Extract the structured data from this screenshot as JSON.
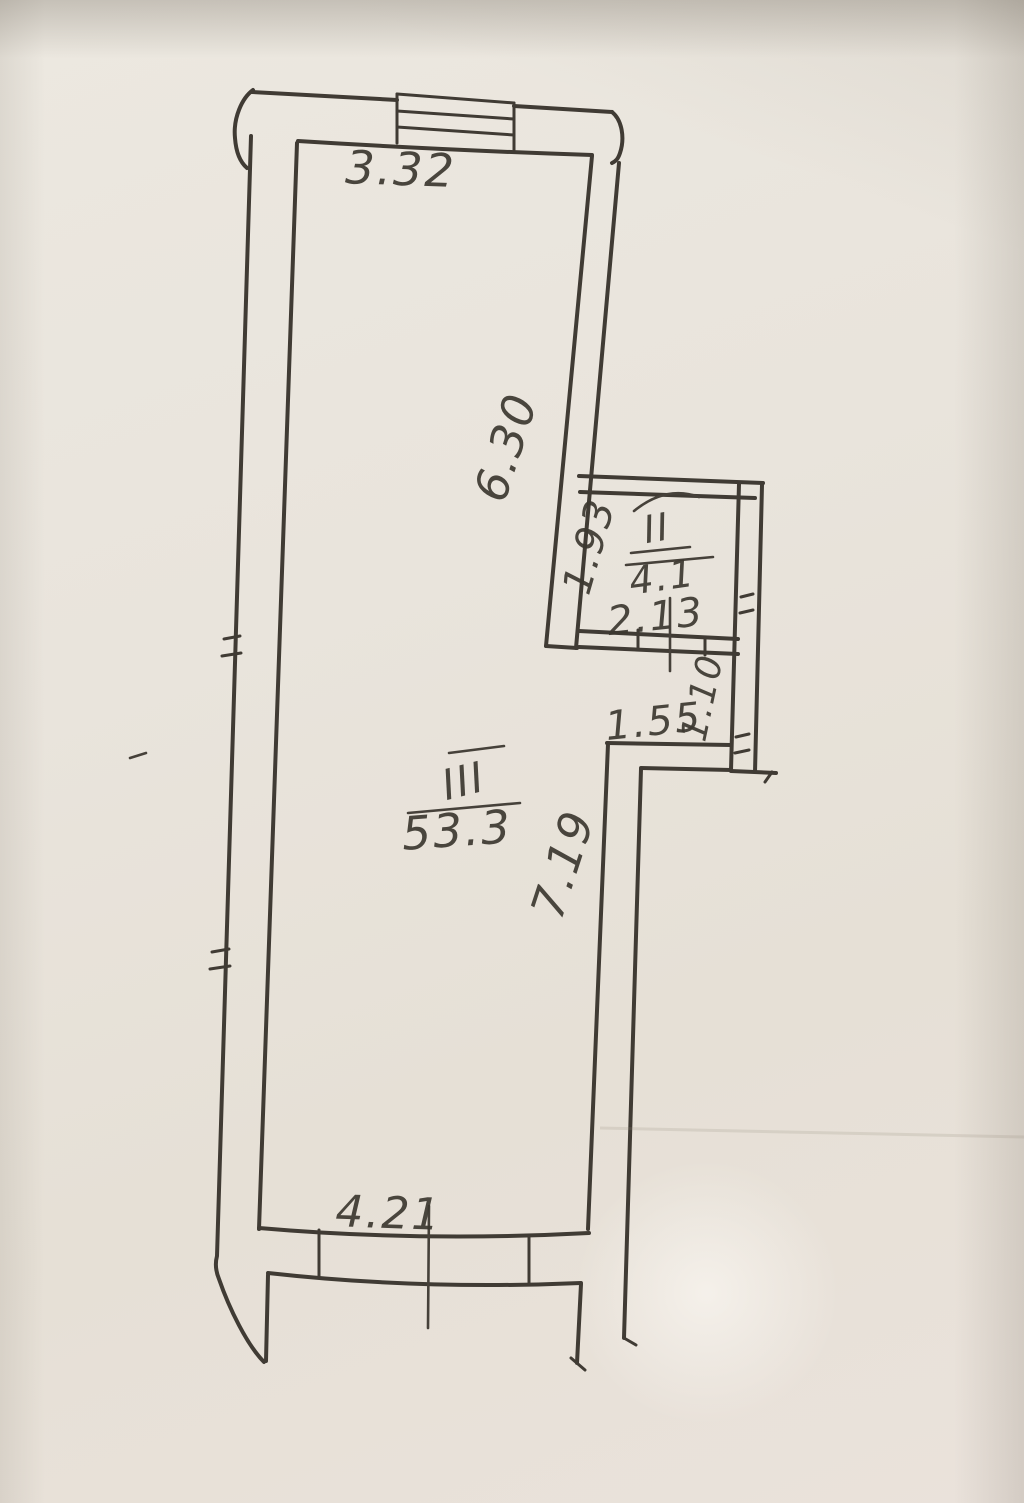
{
  "document": {
    "kind": "hand-drawn floor plan photo",
    "paper_color": "#e9e4dc",
    "ink_color": "#403b34"
  },
  "floor_plan": {
    "rooms": [
      {
        "number": "II",
        "area": "4.1"
      },
      {
        "number": "III",
        "area": "53.3"
      }
    ],
    "dimensions": {
      "top_window_width": "3.32",
      "right_wall_upper_height": "6.30",
      "room2_depth": "1.93",
      "room2_width": "2.13",
      "niche_width": "1.55",
      "niche_depth": "1.10",
      "lower_right_wall_height": "7.19",
      "bottom_window_width": "4.21"
    }
  }
}
